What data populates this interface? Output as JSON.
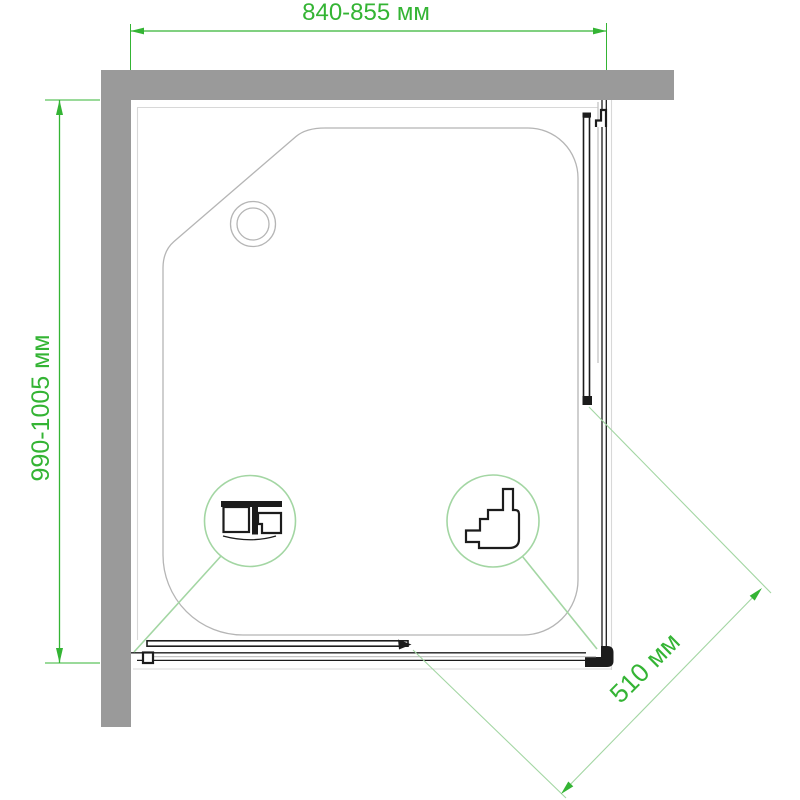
{
  "page": {
    "background": "#ffffff",
    "description_not_rendered": ""
  },
  "dimensions": {
    "top": {
      "label": "840-855 мм",
      "min_mm": 840,
      "max_mm": 855
    },
    "left": {
      "label": "990-1005 мм",
      "min_mm": 990,
      "max_mm": 1005
    },
    "diagonal": {
      "label": "510 мм",
      "value_mm": 510
    }
  },
  "details": {
    "left_callout_icon": "top-rail-roller-profile-icon",
    "right_callout_icon": "bottom-guide-roller-profile-icon"
  },
  "colors": {
    "dimension_green": "#34b434",
    "detail_green": "#a3d6a3",
    "wall_gray": "#9a9a9a",
    "tray_outline": "#b5b5b5",
    "rim_light": "#d8d8d8",
    "glass_light": "#c4c4c4",
    "frame_dark": "#1c1c1c",
    "page_bg": "#ffffff"
  }
}
